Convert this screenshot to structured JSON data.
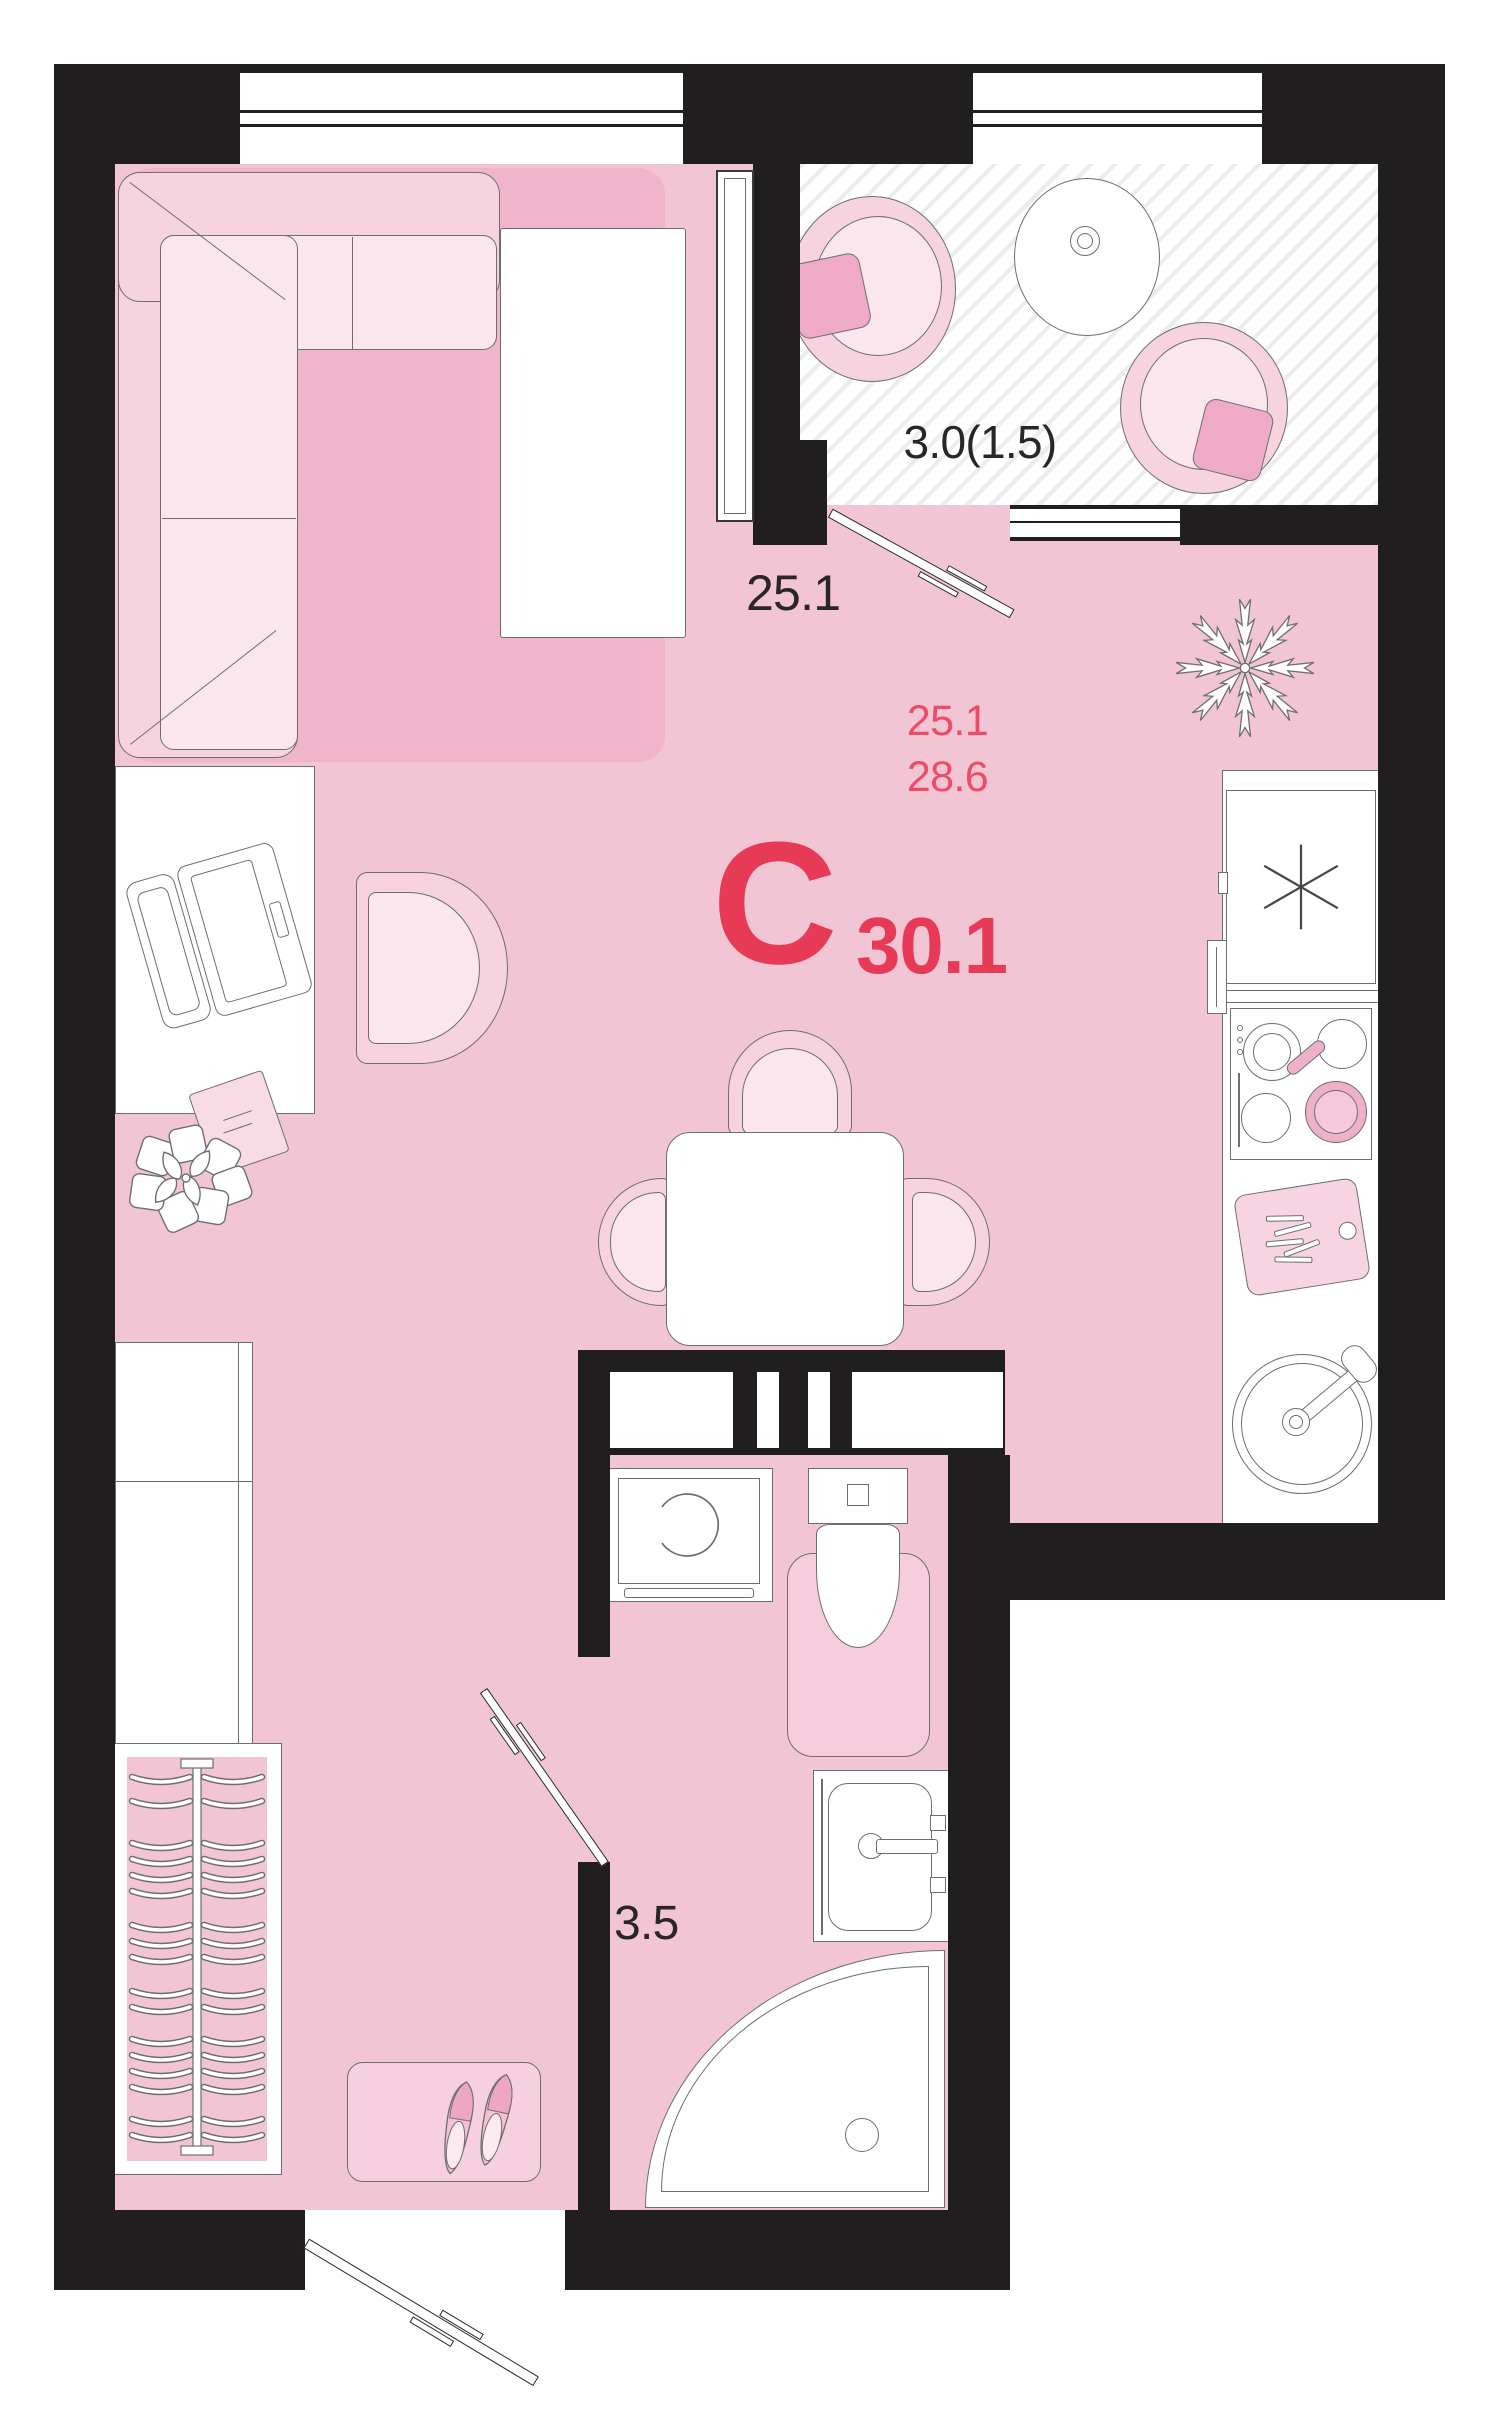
{
  "plan": {
    "unit_type_letter": "С",
    "unit_total_area": "30.1",
    "unit_area_line1": "25.1",
    "unit_area_line2": "28.6",
    "room_label_main": "25.1",
    "room_label_balcony": "3.0(1.5)",
    "room_label_bathroom": "3.5"
  },
  "colors": {
    "wall": "#211e1f",
    "floor": "#f2c5d4",
    "rug": "#f0b5cb",
    "furn-light": "#f7d3df",
    "furn-lighter": "#fbe6ee",
    "pillow": "#efaac7",
    "mat": "#f5cddc",
    "accent": "#ee4c66",
    "accent-strong": "#e63a57",
    "ink": "#2a2627",
    "line": "#6e6e71"
  },
  "furniture": [
    "corner-sofa",
    "bed",
    "pillows",
    "remote-control",
    "desk",
    "laptop",
    "notepad",
    "desk-chair",
    "flower-plant",
    "tall-cabinet",
    "wardrobe-with-hangers",
    "shoe-mat",
    "shoes",
    "dining-table",
    "dining-chairs",
    "fridge",
    "stove",
    "frying-pan",
    "cutting-board",
    "kitchen-sink",
    "washing-machine",
    "toilet",
    "bath-mat",
    "washbasin",
    "shower-cabin",
    "balcony-chairs",
    "balcony-table",
    "fir-tree",
    "entrance-door",
    "bathroom-door",
    "balcony-door"
  ]
}
